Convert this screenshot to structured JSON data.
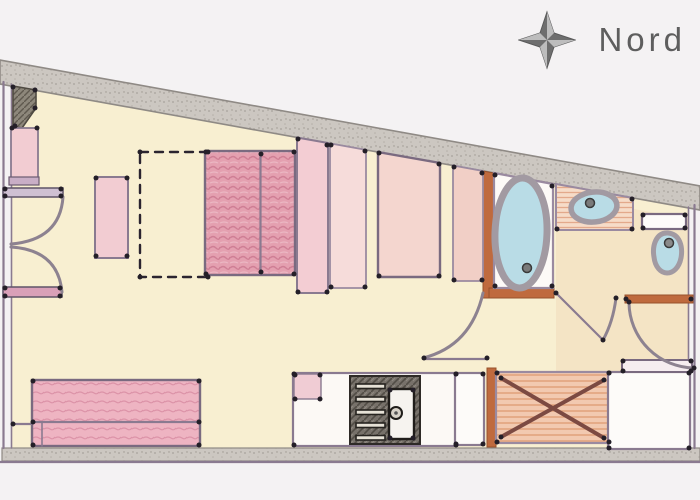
{
  "compass": {
    "icon": "compass-star-icon",
    "label": "Nord"
  },
  "colors": {
    "background": "#f4f2f3",
    "floor_cream": "#f9f1d9",
    "floor_peach": "#f4e2c8",
    "wall_gray": "#ccc7c1",
    "wall_purple": "#8a7a90",
    "wall_orange": "#bf6a3e",
    "arc_gray": "#8d8290",
    "fixture_blue": "#b9dce6",
    "fixture_rim": "#a29aa2",
    "bed_pink": "#e4a0b0",
    "sofa_pink": "#eeb4c2",
    "furniture_pink": "#f3cdd3",
    "appliance_dark": "#77716a",
    "ink": "#2b2430",
    "compass_gray": "#6a6a6a"
  }
}
